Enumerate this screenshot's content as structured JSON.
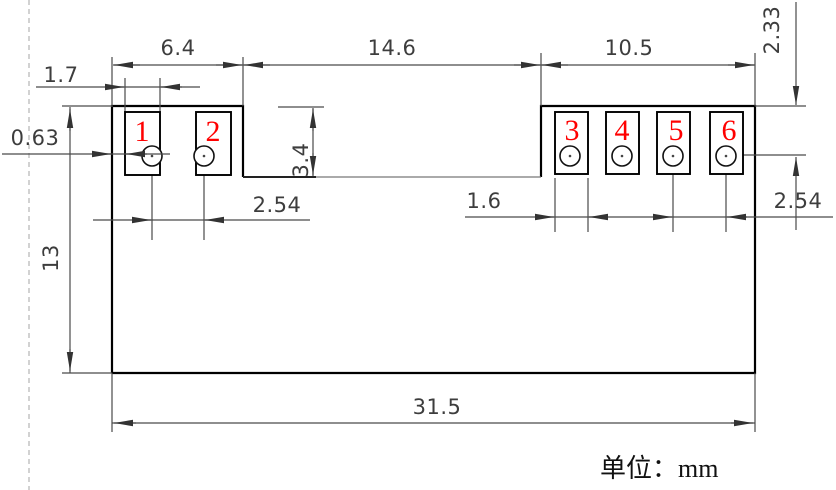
{
  "drawing": {
    "unit_note": "单位：mm",
    "pad_labels": [
      "1",
      "2",
      "3",
      "4",
      "5",
      "6"
    ],
    "dimensions": {
      "left_pad_group_width": "6.4",
      "center_notch_width": "14.6",
      "right_pad_group_width": "10.5",
      "pad1_width": "1.7",
      "left_edge_to_pad1": "0.63",
      "notch_depth": "3.4",
      "top_to_hole_center": "2.33",
      "left_hole_pitch": "2.54",
      "pad3_width": "1.6",
      "right_hole_pitch": "2.54",
      "body_height": "13",
      "body_width": "31.5"
    },
    "colors": {
      "outline": "#000000",
      "dimension_line": "#4a4a4a",
      "dimension_text": "#3d3d3d",
      "pad_label": "#ff0000",
      "centerline": "#b4b4b4",
      "background": "#ffffff"
    }
  }
}
